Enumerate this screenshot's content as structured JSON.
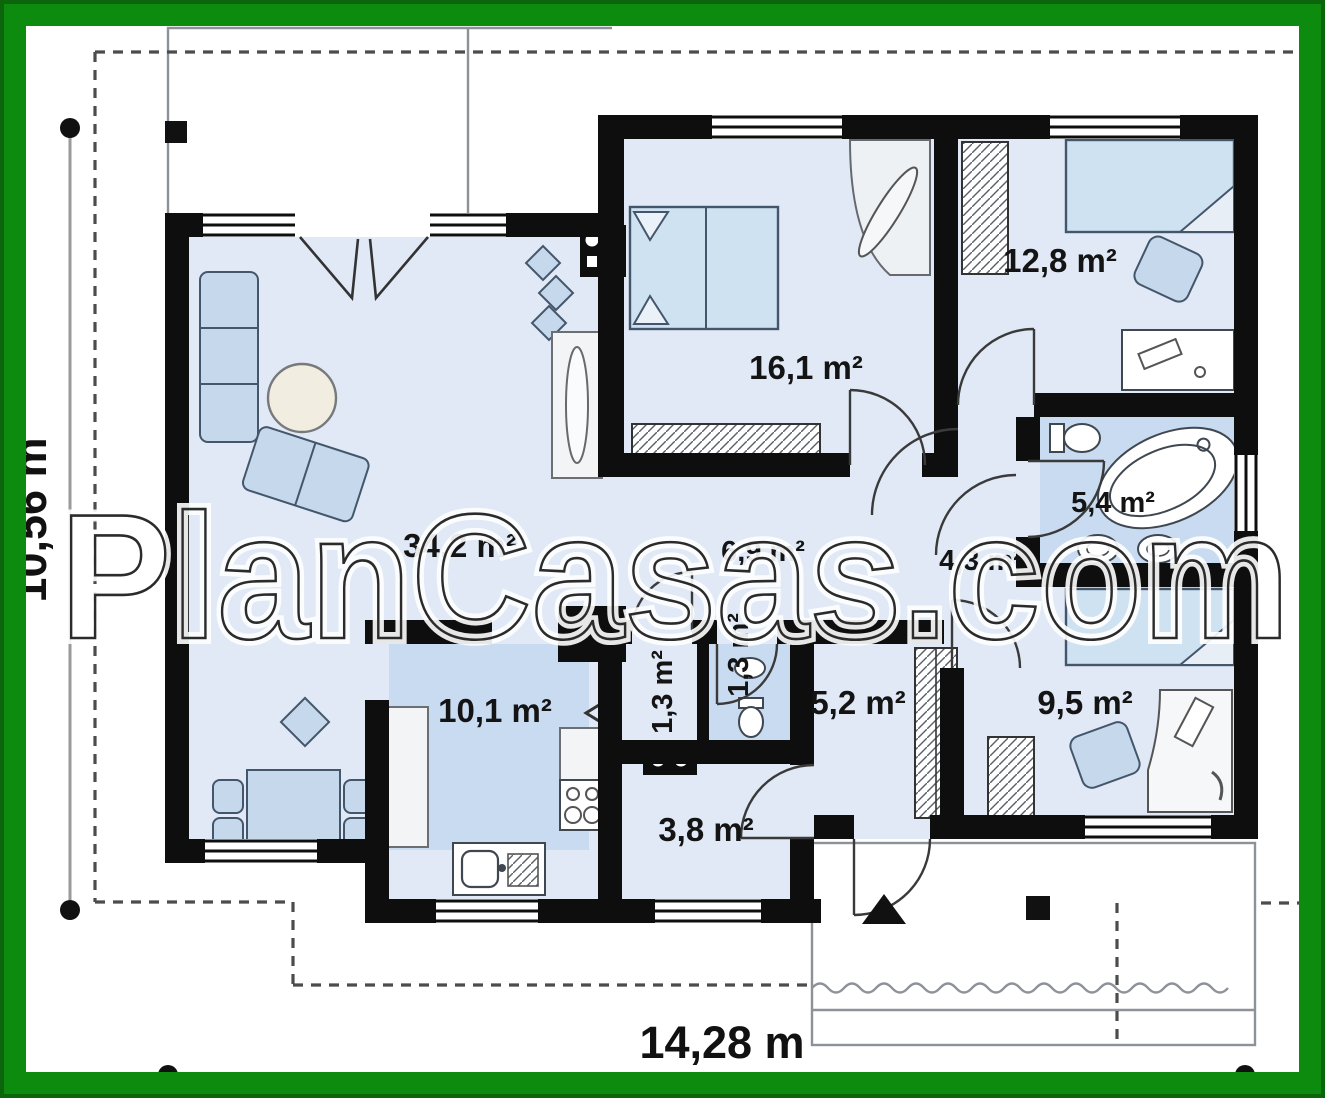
{
  "watermark": "PlanCasas.com",
  "dimensions": {
    "vertical": "10,56 m",
    "horizontal": "14,28 m"
  },
  "rooms": {
    "living": {
      "area": "34,2 m²"
    },
    "bedroom_main": {
      "area": "16,1 m²"
    },
    "bedroom_top": {
      "area": "12,8 m²"
    },
    "bathroom": {
      "area": "5,4 m²"
    },
    "hall": {
      "area": "4,3 m²"
    },
    "corridor": {
      "area": "6,9 m²"
    },
    "closet": {
      "area": "1,3 m²"
    },
    "wc": {
      "area": "1,3 m²"
    },
    "entry_hall": {
      "area": "5,2 m²"
    },
    "bedroom_low": {
      "area": "9,5 m²"
    },
    "kitchen": {
      "area": "10,1 m²"
    },
    "utility": {
      "area": "3,8 m²"
    }
  },
  "colors": {
    "frame_green": "#0c8b0e",
    "floor_light": "#e0e9f5",
    "floor_dark": "#c9dbf0",
    "wall": "#0e0e0e"
  }
}
